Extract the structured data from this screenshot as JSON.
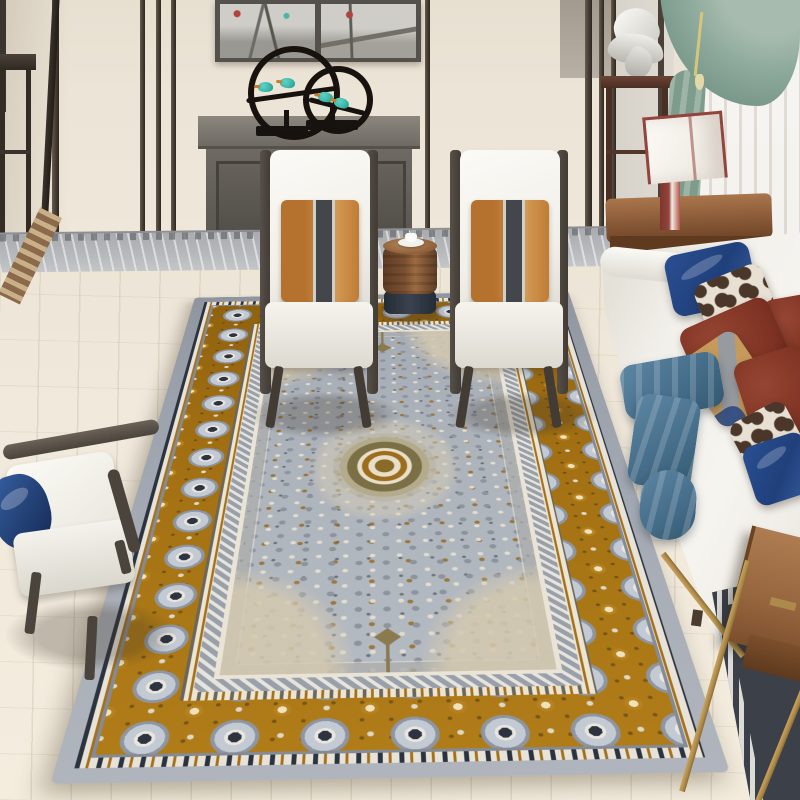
{
  "scene": {
    "type": "living-room photograph",
    "subject": "gray and gold persian-style area rug in a modern chinese living room",
    "objects": [
      {
        "name": "wall-paneling",
        "desc": "cream wall panels with dark wood trim strips"
      },
      {
        "name": "wall-artwork",
        "desc": "two framed ink-wash landscape panels"
      },
      {
        "name": "ring-sculpture",
        "desc": "two black metal rings with teal kingfisher birds on branches"
      },
      {
        "name": "sideboard-cabinet",
        "desc": "gray two-door cabinet with silver teardrop pulls"
      },
      {
        "name": "left-console-table",
        "desc": "tall dark wood console at far left"
      },
      {
        "name": "pedestal-stand",
        "desc": "dark wood plant stand with white abstract sculpture"
      },
      {
        "name": "white-sculpture",
        "desc": "white abstract sculpture"
      },
      {
        "name": "teal-curtain",
        "desc": "sage-teal drape with tassel tie over white sheer"
      },
      {
        "name": "sheer-curtain",
        "desc": "white sheer curtain"
      },
      {
        "name": "table-lamp",
        "desc": "white cube lamp with dark red trim on wood side table"
      },
      {
        "name": "lamp-side-table",
        "desc": "brown wood side table"
      },
      {
        "name": "white-armchair-left",
        "desc": "white armchair with orange striped lumbar pillow"
      },
      {
        "name": "white-armchair-right",
        "desc": "white armchair with orange striped lumbar pillow"
      },
      {
        "name": "drum-side-table",
        "desc": "round wood drum table with white teacup"
      },
      {
        "name": "teacup",
        "desc": "white cup and saucer"
      },
      {
        "name": "sofa",
        "desc": "white fabric sofa along window"
      },
      {
        "name": "sofa-pillows",
        "desc": "navy satin, maroon velvet, tan-gray band and giraffe-print pillows"
      },
      {
        "name": "blue-throw",
        "desc": "steel-blue throw draped over seat"
      },
      {
        "name": "wood-armchair",
        "desc": "dark wood armchair with white cushions and navy pillow"
      },
      {
        "name": "coffee-table",
        "desc": "wood-top coffee table with brass legs"
      },
      {
        "name": "greek-key-rug",
        "desc": "dark rug with white greek-key border under coffee table"
      },
      {
        "name": "marble-border",
        "desc": "gray marble floor strip with meander inlay along wall"
      },
      {
        "name": "area-rug",
        "desc": "gray field rug with ochre-gold rosette border and olive medallion"
      },
      {
        "name": "wood-floor",
        "desc": "ivory plank floor"
      }
    ]
  },
  "colors": {
    "wall_cream": "#ece4d6",
    "wall_trim": "#4b4138",
    "wall_gray": "#dfdbd3",
    "marble": "#b7babc",
    "floor": "#f0e9dc",
    "inlay_brown": "#8a6a4a",
    "cabinet": "#6e6a63",
    "art_bg": "#cfcdc8",
    "art_frame": "#54504b",
    "bird_teal": "#3ab5a8",
    "ring_black": "#17120e",
    "curtain_teal": "#8aa79a",
    "sheer": "#f4f2ee",
    "lamp_red": "#93443c",
    "table_wood": "#8a5a38",
    "chair_white": "#f1efe9",
    "chair_frame": "#423c35",
    "pillow_stripe": "#43474c",
    "drum_wood": "#7a5031",
    "drum_dark": "#39424e",
    "sofa_white": "#f2f0eb",
    "pillow_navy": "#20407b",
    "pillow_maroon": "#7c3122",
    "pillow_tan": "#c59a5b",
    "band_gray": "#979ba0",
    "pattern_dark": "#4a372a",
    "pattern_light": "#e8e1d3",
    "throw_blue": "#476f8c",
    "wood_chair": "#4a443c",
    "ctable_wood": "#96653e",
    "ctable_gold": "#ad8a4c",
    "keyrug": "#3b4049",
    "rug_gray_band": "#9ba1ab",
    "rug_gold": "#a06e12",
    "rug_field": "#adb3bb",
    "rug_silver": "#c3cad3",
    "rug_navy": "#2c3340",
    "rug_olive": "#7b6f45"
  }
}
